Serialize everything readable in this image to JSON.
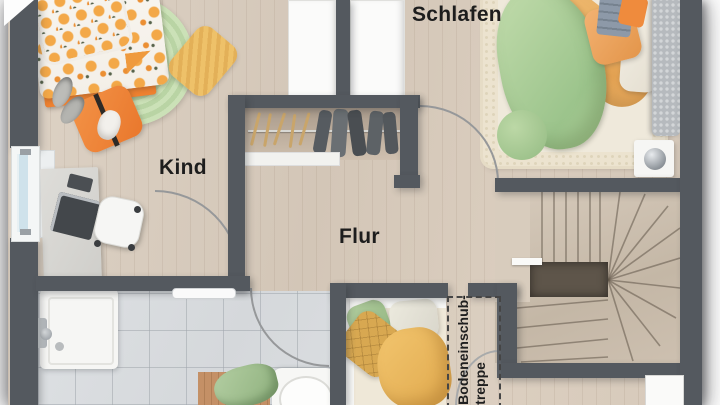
{
  "floorplan": {
    "labels": {
      "bedroom": "Schlafen",
      "child_room": "Kind",
      "hallway": "Flur",
      "attic_ladder_line1": "Bodeneinschub-",
      "attic_ladder_line2": "treppe"
    },
    "colors": {
      "wall": "#54595f",
      "wood_floor": "#d9cec1",
      "tile_floor": "#d9dcdf",
      "stair_wood": "#cfc3b4",
      "accent_orange": "#ef8435",
      "accent_green": "#aecd97",
      "accent_yellow": "#eec169",
      "label_text": "#1d1d1d"
    }
  }
}
